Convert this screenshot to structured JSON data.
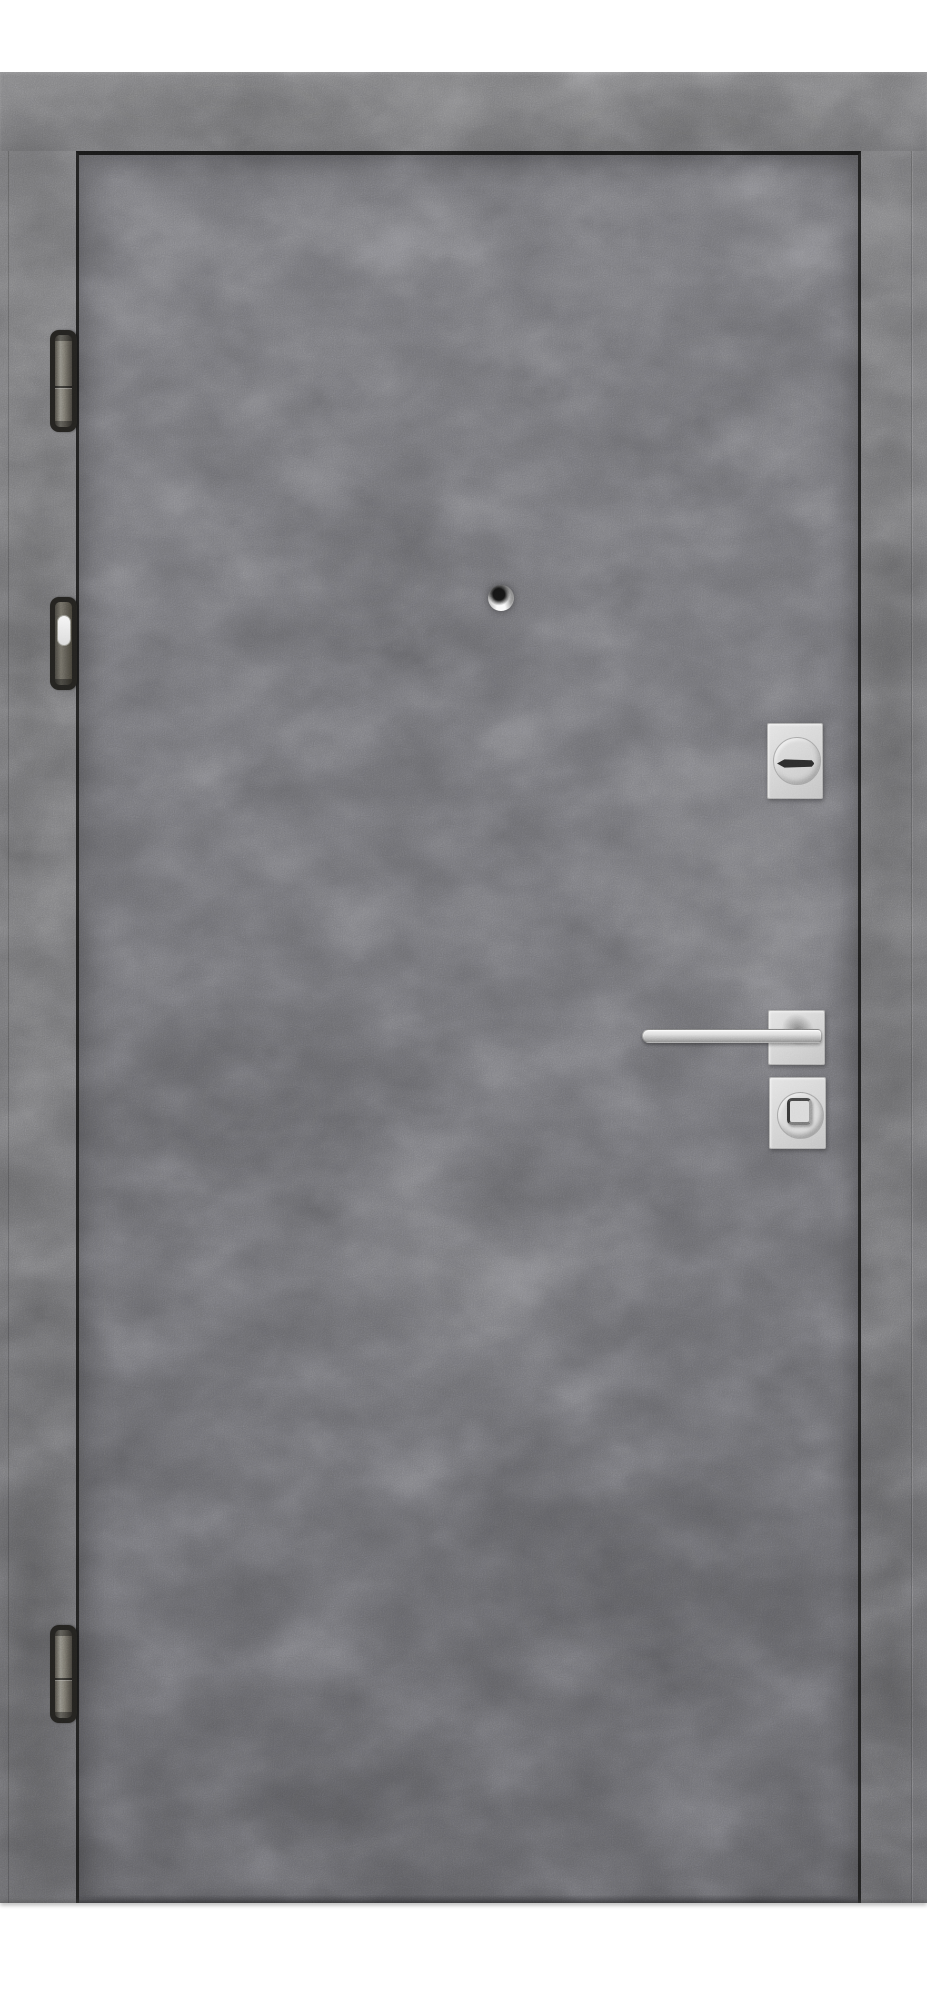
{
  "scene": {
    "kind": "product-photo",
    "description": "Closed metal entry door with gray concrete-texture finish, hinged on the left, photographed straight on against a white background",
    "background_color": "#ffffff"
  },
  "door": {
    "finish": "concrete gray",
    "frame": {
      "label": "door frame"
    },
    "leaf": {
      "label": "door leaf"
    },
    "hinges": [
      {
        "label": "top hinge"
      },
      {
        "label": "middle hinge with white cap"
      },
      {
        "label": "bottom hinge"
      }
    ],
    "peephole": {
      "label": "peephole"
    },
    "escutcheon": {
      "label": "keyhole cover plate"
    },
    "keyhole": {
      "label": "horizontal keyhole slot"
    },
    "handle": {
      "label": "square-rosette lever handle"
    },
    "lock": {
      "label": "thumbturn lock plate"
    }
  },
  "palette": {
    "background": "#ffffff",
    "frame_gray": "#6e6e70",
    "leaf_gray": "#67676b",
    "gap_shadow": "#1d1d1d",
    "hinge_body": "#23221f",
    "hinge_pin": "#807d74",
    "hardware_plate": "#d5d5d5",
    "handle_metal": "#d0d0d0",
    "keyhole_dark": "#2b2b2b",
    "hinge_cap_white": "#eeeeee"
  }
}
